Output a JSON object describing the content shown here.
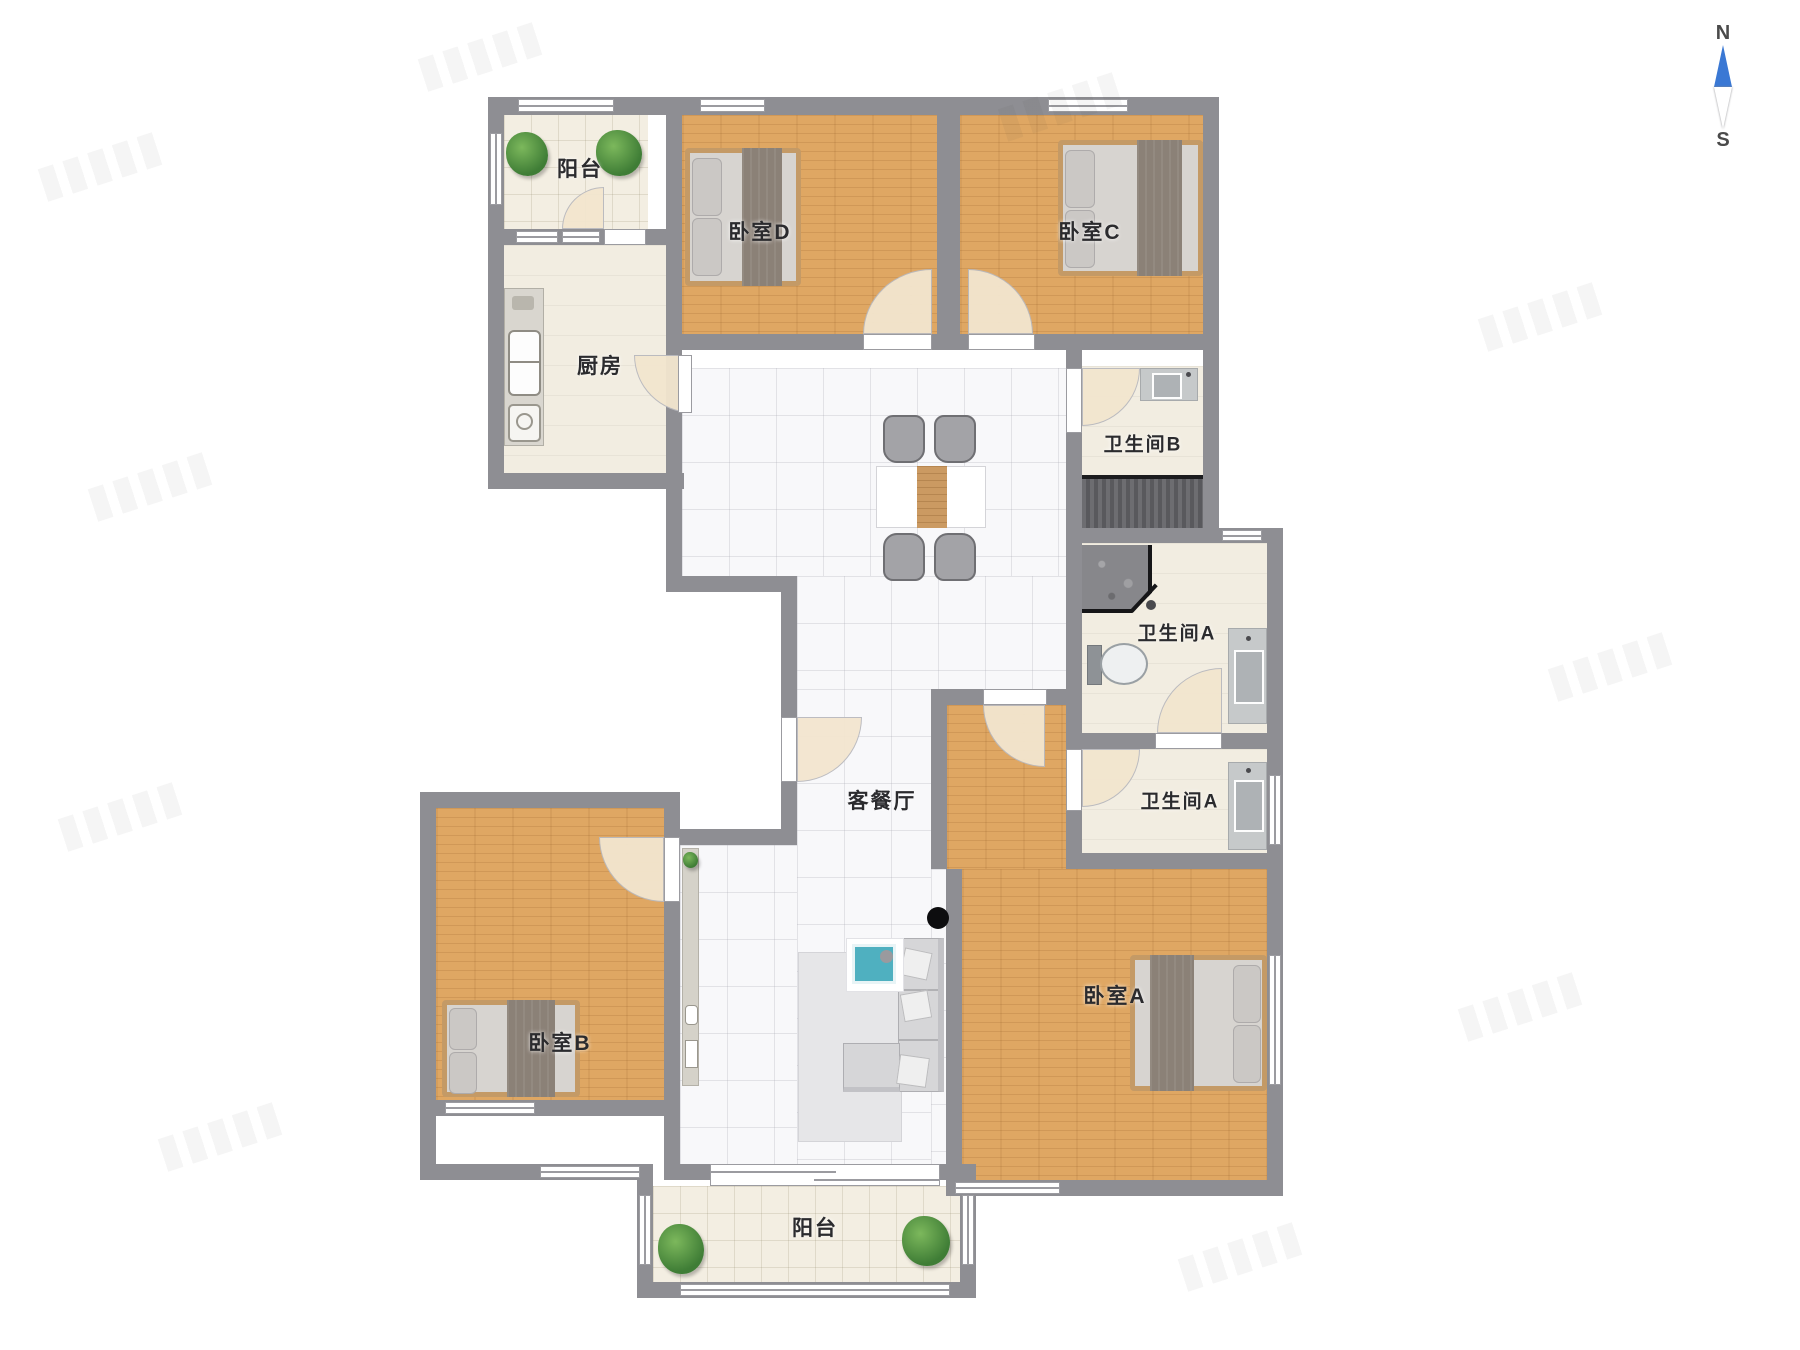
{
  "rooms": {
    "balcony_top": {
      "label": "阳台"
    },
    "kitchen": {
      "label": "厨房"
    },
    "bedroom_d": {
      "label": "卧室D"
    },
    "bedroom_c": {
      "label": "卧室C"
    },
    "bathroom_b": {
      "label": "卫生间B"
    },
    "bathroom_a_upper": {
      "label": "卫生间A"
    },
    "bathroom_a_lower": {
      "label": "卫生间A"
    },
    "living_dining": {
      "label": "客餐厅"
    },
    "bedroom_b": {
      "label": "卧室B"
    },
    "bedroom_a": {
      "label": "卧室A"
    },
    "balcony_bottom": {
      "label": "阳台"
    }
  },
  "compass": {
    "north": "N",
    "south": "S"
  },
  "colors": {
    "wall": "#8e8e93",
    "wood_floor": "#dfa763",
    "marble_floor": "#f8f8fa",
    "cream_floor": "#f3eee2",
    "door_arc": "#f3e6cf",
    "compass_blue": "#3a78d4",
    "coffee_table_teal": "#4fb0c0",
    "blanket": "#8b8177"
  }
}
